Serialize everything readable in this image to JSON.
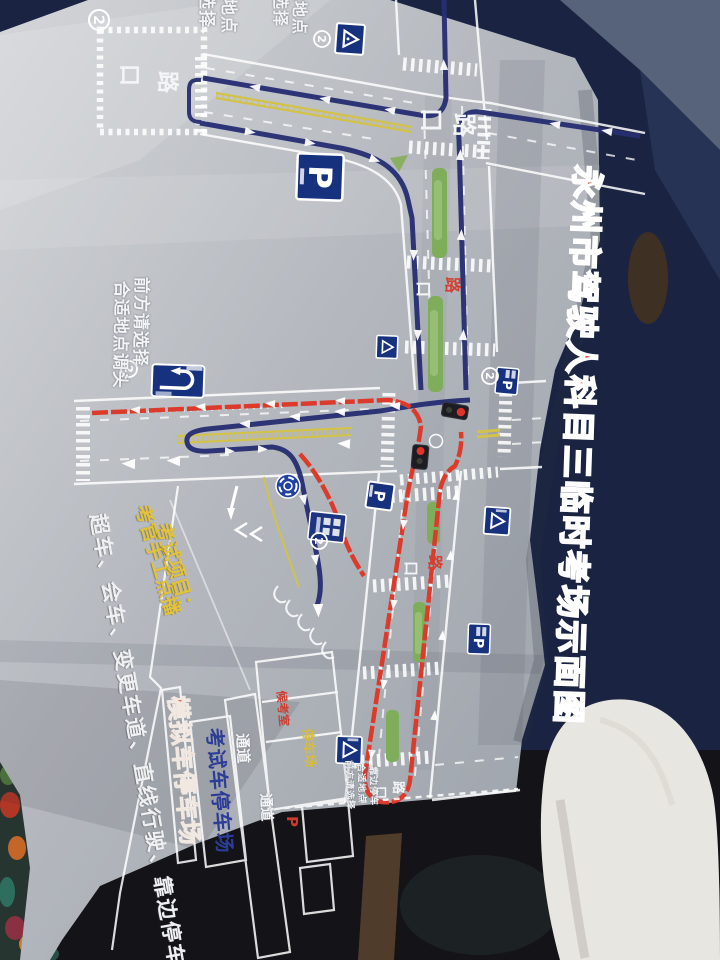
{
  "title": {
    "text": "永州市驾驶人科目三临时考场示面图",
    "color": "#d93a26"
  },
  "signs": {
    "two": "2",
    "p": "P",
    "eight": "8"
  },
  "labels": {
    "kou": "口",
    "lu": "路"
  },
  "instructions": {
    "uturn_col1": "前方请选择",
    "uturn_col2": "合适地点调头",
    "top_col1": "前方请选择",
    "top_col2": "合适地点",
    "pullover_col1": "前方请选择",
    "pullover_col2": "合适地点",
    "pullover_col3": "靠边停车"
  },
  "notes": {
    "examiner": "考官手工点播",
    "exam_items_heading": "考试项目：",
    "exam_items": "超车、会车、变更车道、直线行驶、靠边停车"
  },
  "areas": {
    "simulated_lot": "模拟车停车场",
    "test_car_lot": "考试车停车场",
    "corridor_1": "通道",
    "corridor_2": "通道",
    "waiting_room": "候考室",
    "parking": "停车场"
  },
  "colors": {
    "paper": "#b8bcc2",
    "route_navy": "#282f72",
    "route_red": "#dc3a2b",
    "sign_blue": "#1b3a8c",
    "lane_yellow": "#d2c24c",
    "median_green": "#7fae5a",
    "title_red": "#d93a26",
    "background_navy": "#1a2442"
  }
}
